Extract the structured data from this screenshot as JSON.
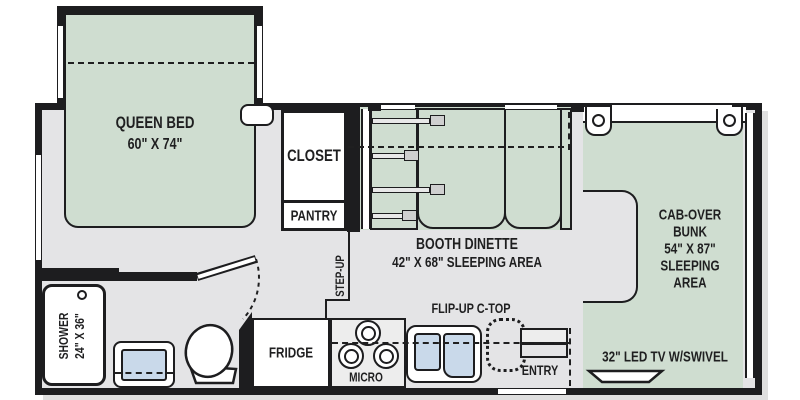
{
  "colors": {
    "wall": "#1d1d1f",
    "floor": "#e4e4e6",
    "furniture_green": "#cfddd0",
    "sink_blue": "#c9d9ea",
    "fixture_white": "#ffffff"
  },
  "rooms": {
    "queen_bed": {
      "line1": "QUEEN BED",
      "line2": "60\" X 74\""
    },
    "closet": {
      "label": "CLOSET"
    },
    "pantry": {
      "label": "PANTRY"
    },
    "step_up": {
      "label": "STEP-UP"
    },
    "booth_dinette": {
      "line1": "BOOTH DINETTE",
      "line2": "42\" X 68\" SLEEPING AREA"
    },
    "cab_over_bunk": {
      "lines": [
        "CAB-OVER",
        "BUNK",
        "54\" X 87\"",
        "SLEEPING",
        "AREA"
      ]
    },
    "shower": {
      "line1": "SHOWER",
      "line2": "24\" X 36\""
    },
    "fridge": {
      "label": "FRIDGE"
    },
    "micro": {
      "label": "MICRO"
    },
    "flip_up_ctop": {
      "label": "FLIP-UP C-TOP"
    },
    "entry": {
      "label": "ENTRY"
    },
    "tv": {
      "label": "32\" LED TV W/SWIVEL"
    }
  }
}
